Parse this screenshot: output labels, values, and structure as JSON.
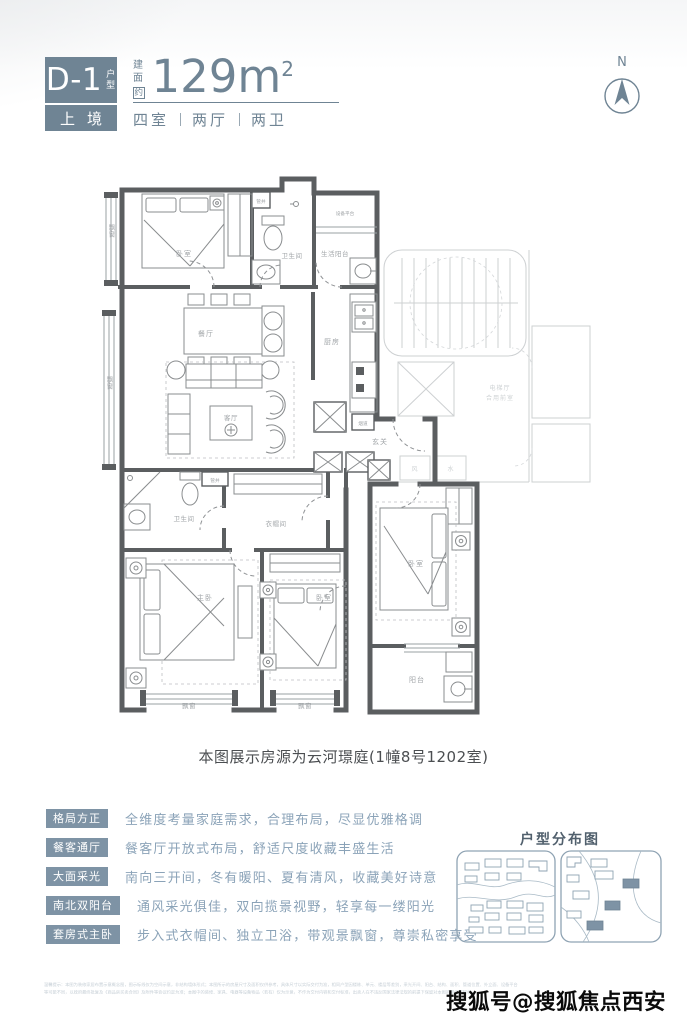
{
  "header": {
    "unit_code": "D-1",
    "unit_code_suffix": "户型",
    "series_name": "上境",
    "area_label_chars": [
      "建",
      "面",
      "约"
    ],
    "area_value": "129m",
    "area_superscript": "2",
    "rooms_summary": [
      "四室",
      "两厅",
      "两卫"
    ]
  },
  "compass": {
    "north_label": "N"
  },
  "plan": {
    "rooms": {
      "bay_window": "飘窗",
      "bedroom": "卧室",
      "master_bedroom": "主卧",
      "bathroom": "卫生间",
      "pipe_shaft": "管井",
      "flue": "烟道",
      "equipment_platform": "设备平台",
      "service_balcony": "生活阳台",
      "dining_room": "餐厅",
      "kitchen": "厨房",
      "living_room": "客厅",
      "entry": "玄关",
      "cloakroom": "衣帽间",
      "balcony": "阳台",
      "vent_shaft": "风",
      "water_shaft": "水",
      "elevator_hall": "电梯厅",
      "shared_lobby": "合用前室"
    }
  },
  "caption": "本图展示房源为云河璟庭(1幢8号1202室)",
  "features": [
    {
      "tag": "格局方正",
      "desc": "全维度考量家庭需求，合理布局，尽显优雅格调"
    },
    {
      "tag": "餐客通厅",
      "desc": "餐客厅开放式布局，舒适尺度收藏丰盛生活"
    },
    {
      "tag": "大面采光",
      "desc": "南向三开间，冬有暖阳、夏有清风，收藏美好诗意"
    },
    {
      "tag": "南北双阳台",
      "desc": "通风采光俱佳，双向揽景视野，轻享每一缕阳光"
    },
    {
      "tag": "套房式主卧",
      "desc": "步入式衣帽间、独立卫浴，带观景飘窗，尊崇私密享受"
    }
  ],
  "distribution_map": {
    "title": "户型分布图"
  },
  "disclaimer": {
    "line1": "温馨提示：本图为装修家居布置示意概念图，图示标线仅为空间示意，非结构墙体形式；本图所示的房屋尺寸及面积仅供参考，具体尺寸以实际交付为准，相同户型因楼栋、单元、楼层等差别，采光开间、阳台、结构、面积、管道位置、外立面、设备平台",
    "line2": "等可能不同，以政府最终批复及《商品房买卖合同》及附件等协议约定为准；本图中的装修、家具、电器等设备物品（若有）仅为示意，不作为交付内容和交付标准，出卖人在不违反国家法律法规的前提下保留对本图的最终解释权。"
  },
  "watermark": "搜狐号@搜狐焦点西安站"
}
